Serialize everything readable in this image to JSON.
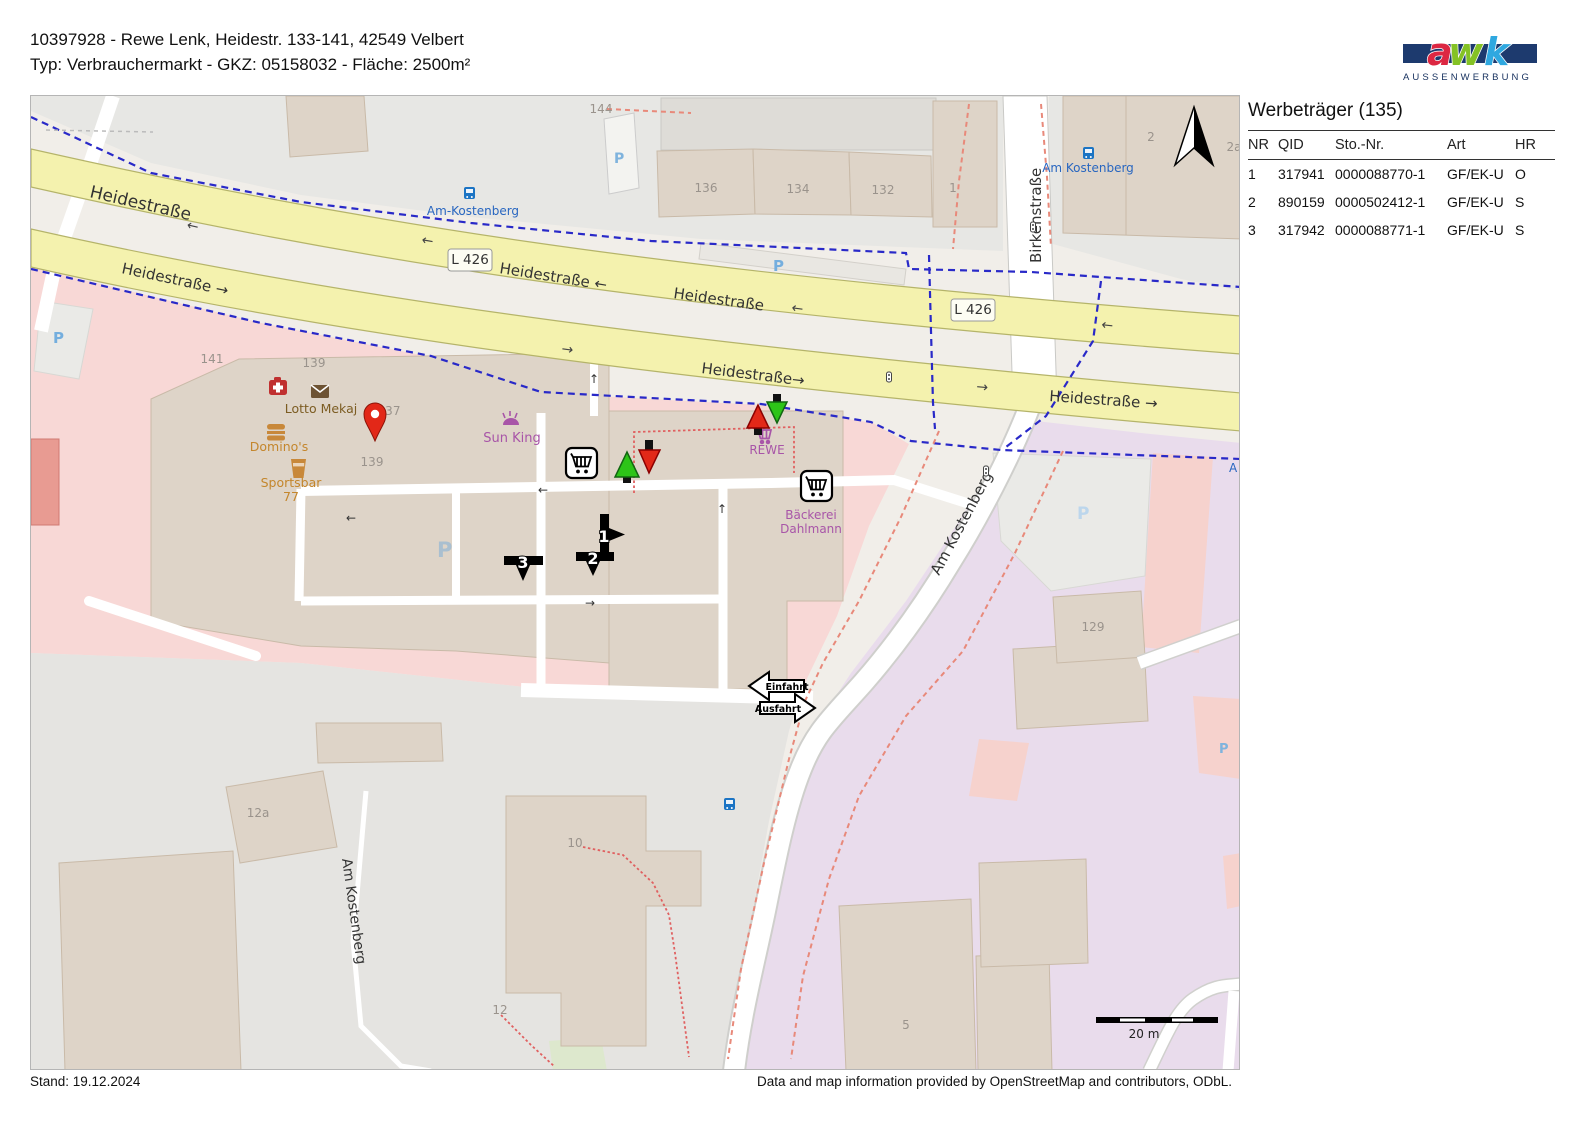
{
  "header": {
    "line1": "10397928 - Rewe Lenk, Heidestr. 133-141, 42549 Velbert",
    "line2": "Typ: Verbrauchermarkt - GKZ: 05158032 - Fläche: 2500m²"
  },
  "logo": {
    "letters": [
      "a",
      "w",
      "k"
    ],
    "subtitle": "AUSSENWERBUNG"
  },
  "sidebar": {
    "title": "Werbeträger (135)",
    "columns": [
      "NR",
      "QID",
      "Sto.-Nr.",
      "Art",
      "HR"
    ],
    "rows": [
      [
        "1",
        "317941",
        "0000088770-1",
        "GF/EK-U",
        "O"
      ],
      [
        "2",
        "890159",
        "0000502412-1",
        "GF/EK-U",
        "S"
      ],
      [
        "3",
        "317942",
        "0000088771-1",
        "GF/EK-U",
        "S"
      ]
    ]
  },
  "map": {
    "streets": {
      "heidestrasse": "Heidestraße",
      "heidestrasse_w": "Heidestraße ←",
      "heidestrasse_e": "Heidestraße →",
      "heidestrasse_e2": "Heidestraße→",
      "l426": "L 426",
      "birkenstrasse": "Birkenstraße",
      "am_kostenberg": "Am Kostenberg"
    },
    "bus_stops": {
      "top": "Am-Kostenberg",
      "right": "Am Kostenberg"
    },
    "arrows": {
      "left": "←",
      "right": "→",
      "up": "↑"
    },
    "house_numbers": [
      "144",
      "141",
      "139",
      "137",
      "139",
      "136",
      "134",
      "132",
      "1",
      "2",
      "2a",
      "129",
      "12a",
      "10",
      "12",
      "5"
    ],
    "pois": {
      "lotto": "Lotto Mekaj",
      "dominos": "Domino's",
      "sportsbar": "Sportsbar",
      "sportsbar2": "77",
      "sunking": "Sun King",
      "rewe": "REWE",
      "baeckerei": "Bäckerei",
      "dahlmann": "Dahlmann"
    },
    "markers": {
      "m1": "1",
      "m2": "2",
      "m3": "3"
    },
    "signs": {
      "einfahrt": "Einfahrt",
      "ausfahrt": "Ausfahrt"
    },
    "parking_label": "P",
    "partial_street_label": "A",
    "scale_label": "20 m"
  },
  "footer": {
    "stand": "Stand: 19.12.2024",
    "attribution": "Data and map information provided by OpenStreetMap and contributors, ODbL."
  },
  "colors": {
    "road_yellow": "#f4f2ae",
    "road_yellow_border": "#b5b46a",
    "retail_pink": "#f8d8d6",
    "residential_lavender": "#e9dcec",
    "building": "#ded4c8",
    "building_border": "#c9baa8",
    "grey_area": "#e7e7e4",
    "marker_red": "#e22818",
    "marker_green": "#2dc418",
    "cycleway_blue": "#2929c8",
    "boundary_red": "#e8897a",
    "poi_purple": "#a855a8",
    "poi_orange": "#c4862c",
    "poi_brown": "#7c5c22",
    "transit_blue": "#1b74c4",
    "parking_blue": "#74aede",
    "logo_navy": "#1d3a6e",
    "logo_a": "#dc2742",
    "logo_w": "#84c225",
    "logo_k": "#2fa8e0"
  }
}
